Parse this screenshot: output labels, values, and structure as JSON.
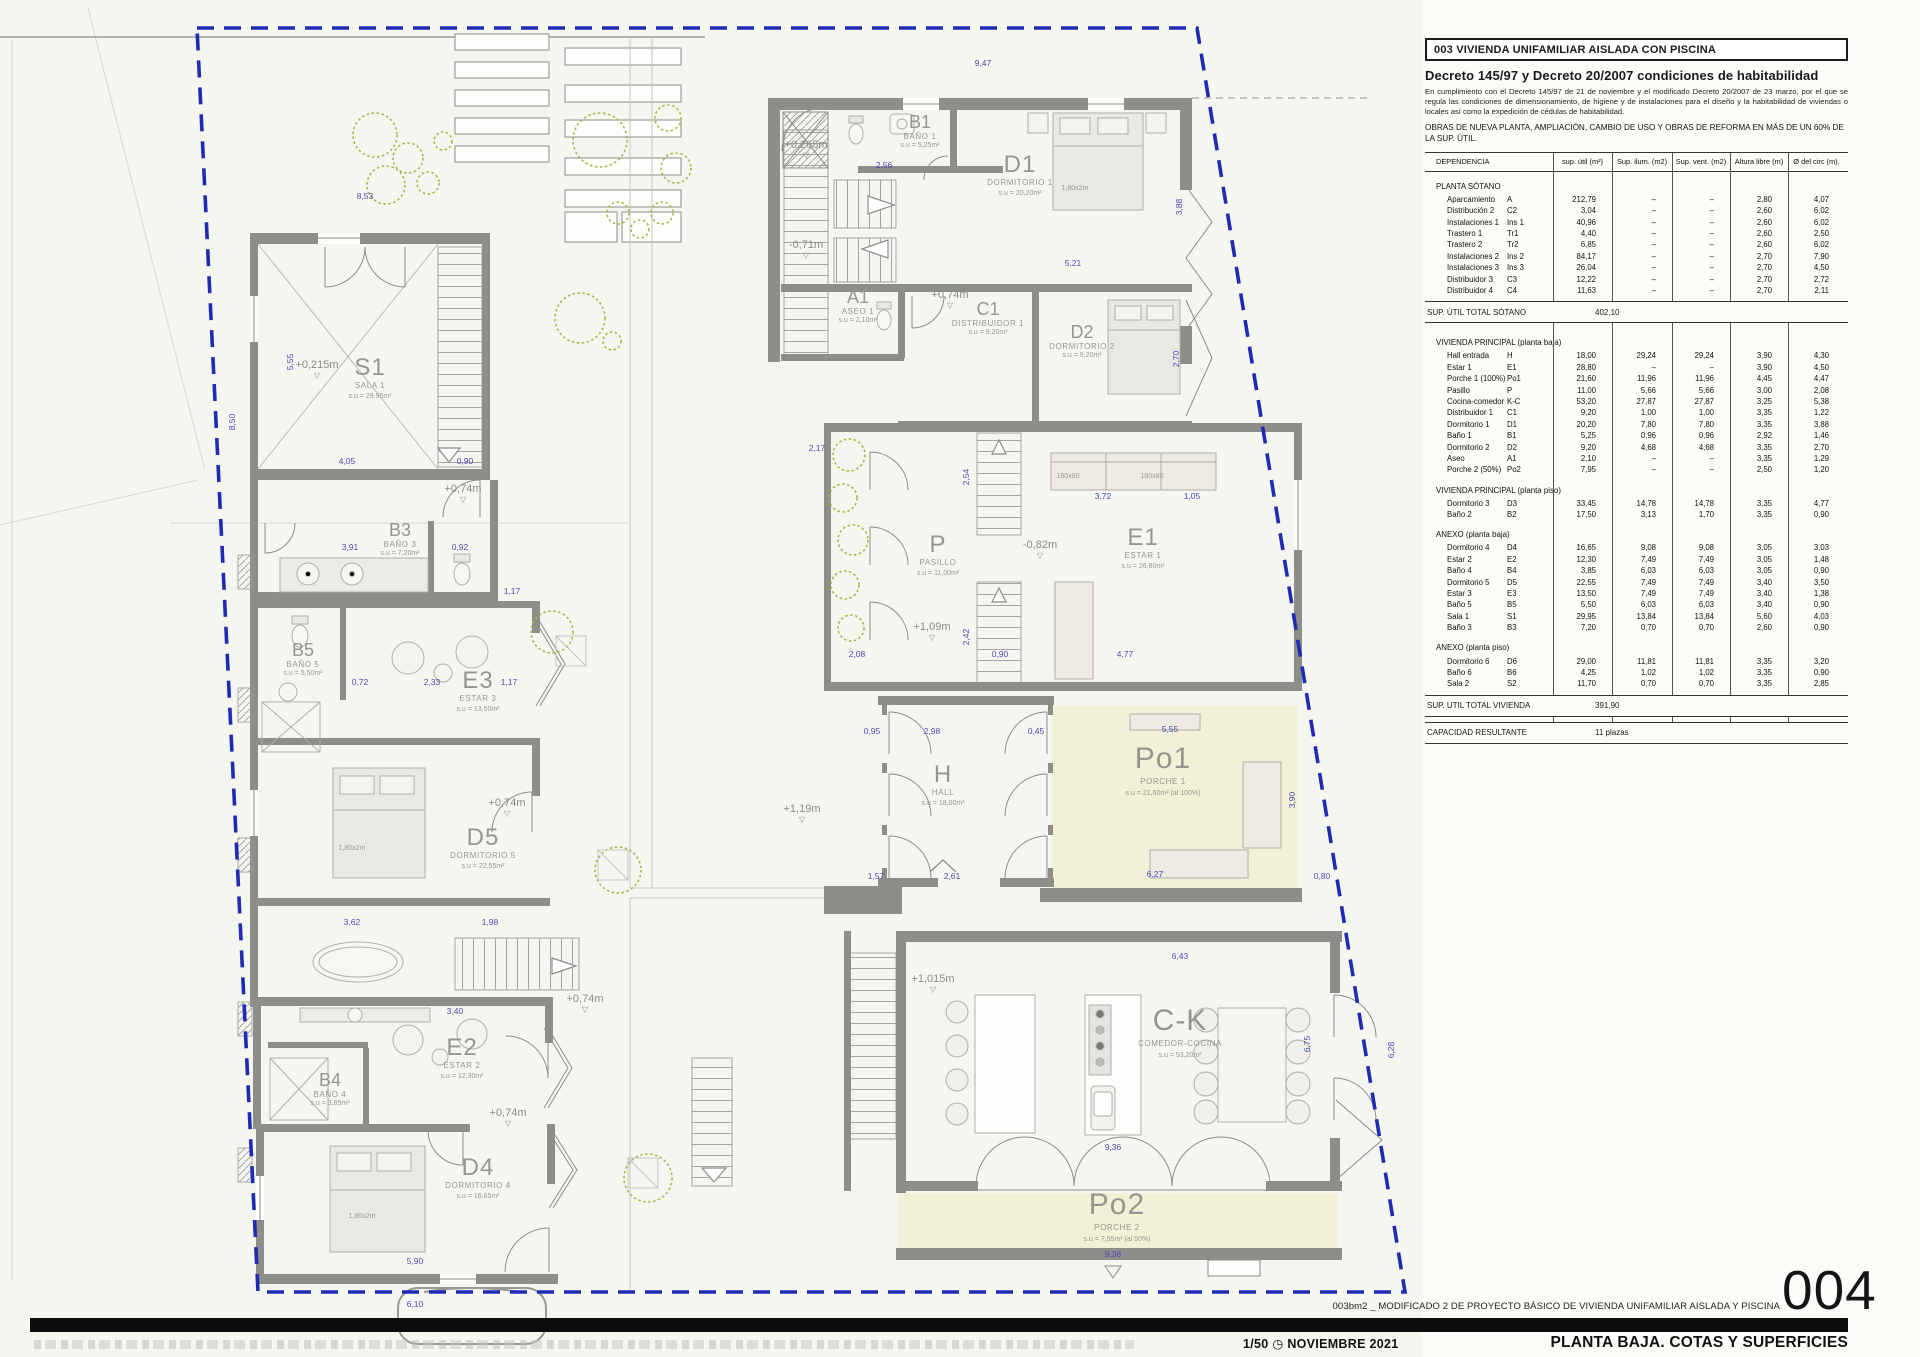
{
  "panel": {
    "title": "003 VIVIENDA UNIFAMILIAR AISLADA CON PISCINA",
    "decree_heading": "Decreto 145/97 y Decreto 20/2007 condiciones de habitabilidad",
    "decree_body": "En cumplimiento con el Decreto 145/97 de 21 de noviembre y el modificado Decreto 20/2007 de 23 marzo, por el que se regula las condiciones de dimensionamiento, de higiene y de instalaciones para el diseño y la habitabilidad de viviendas o locales así como la expedición de cédulas de habitabilidad.",
    "works_note": "OBRAS DE NUEVA PLANTA, AMPLIACIÓN, CAMBIO DE USO Y OBRAS DE REFORMA EN MÁS DE UN 60% DE LA SUP. ÚTIL.",
    "columns": [
      "DEPENDENCIA",
      "sup. útil (m²)",
      "Sup. ilum. (m2)",
      "Sup. vent. (m2)",
      "Altura libre (m)",
      "Ø del circ (m)."
    ],
    "rows": [
      {
        "t": "sec",
        "h": "PLANTA SÓTANO"
      },
      {
        "t": "r",
        "c": [
          "Aparcamiento",
          "A",
          "212,79",
          "–",
          "–",
          "2,80",
          "4,07"
        ]
      },
      {
        "t": "r",
        "c": [
          "Distribución 2",
          "C2",
          "3,04",
          "–",
          "–",
          "2,60",
          "6,02"
        ]
      },
      {
        "t": "r",
        "c": [
          "Instalaciones 1",
          "Ins 1",
          "40,96",
          "–",
          "–",
          "2,60",
          "6,02"
        ]
      },
      {
        "t": "r",
        "c": [
          "Trastero 1",
          "Tr1",
          "4,40",
          "–",
          "–",
          "2,60",
          "2,50"
        ]
      },
      {
        "t": "r",
        "c": [
          "Trastero 2",
          "Tr2",
          "6,85",
          "–",
          "–",
          "2,60",
          "6,02"
        ]
      },
      {
        "t": "r",
        "c": [
          "Instalaciones 2",
          "Ins 2",
          "84,17",
          "–",
          "–",
          "2,70",
          "7,90"
        ]
      },
      {
        "t": "r",
        "c": [
          "Instalaciones 3",
          "Ins 3",
          "26,04",
          "–",
          "–",
          "2,70",
          "4,50"
        ]
      },
      {
        "t": "r",
        "c": [
          "Distribuidor 3",
          "C3",
          "12,22",
          "–",
          "–",
          "2,70",
          "2,72"
        ]
      },
      {
        "t": "r",
        "c": [
          "Distribuidor 4",
          "C4",
          "11,63",
          "–",
          "–",
          "2,70",
          "2,11"
        ]
      },
      {
        "t": "tot",
        "l": "SUP. ÚTIL TOTAL SÓTANO",
        "v": "402,10"
      },
      {
        "t": "sec",
        "h": "VIVIENDA PRINCIPAL (planta baja)"
      },
      {
        "t": "r",
        "c": [
          "Hall entrada",
          "H",
          "18,00",
          "29,24",
          "29,24",
          "3,90",
          "4,30"
        ]
      },
      {
        "t": "r",
        "c": [
          "Estar 1",
          "E1",
          "28,80",
          "–",
          "–",
          "3,90",
          "4,50"
        ]
      },
      {
        "t": "r",
        "c": [
          "Porche 1 (100%)",
          "Po1",
          "21,60",
          "11,96",
          "11,96",
          "4,45",
          "4,47"
        ]
      },
      {
        "t": "r",
        "c": [
          "Pasillo",
          "P",
          "11,00",
          "5,66",
          "5,66",
          "3,00",
          "2,08"
        ]
      },
      {
        "t": "r",
        "c": [
          "Cocina-comedor",
          "K-C",
          "53,20",
          "27,87",
          "27,87",
          "3,25",
          "5,38"
        ]
      },
      {
        "t": "r",
        "c": [
          "Distribuidor 1",
          "C1",
          "9,20",
          "1,00",
          "1,00",
          "3,35",
          "1,22"
        ]
      },
      {
        "t": "r",
        "c": [
          "Dormitorio 1",
          "D1",
          "20,20",
          "7,80",
          "7,80",
          "3,35",
          "3,88"
        ]
      },
      {
        "t": "r",
        "c": [
          "Baño 1",
          "B1",
          "5,25",
          "0,96",
          "0,96",
          "2,92",
          "1,46"
        ]
      },
      {
        "t": "r",
        "c": [
          "Dormitorio 2",
          "D2",
          "9,20",
          "4,68",
          "4,68",
          "3,35",
          "2,70"
        ]
      },
      {
        "t": "r",
        "c": [
          "Aseo",
          "A1",
          "2,10",
          "–",
          "–",
          "3,35",
          "1,29"
        ]
      },
      {
        "t": "r",
        "c": [
          "Porche 2 (50%)",
          "Po2",
          "7,95",
          "–",
          "–",
          "2,50",
          "1,20"
        ]
      },
      {
        "t": "sec",
        "h": "VIVIENDA PRINCIPAL (planta piso)"
      },
      {
        "t": "r",
        "c": [
          "Dormitorio 3",
          "D3",
          "33,45",
          "14,78",
          "14,78",
          "3,35",
          "4,77"
        ]
      },
      {
        "t": "r",
        "c": [
          "Baño 2",
          "B2",
          "17,50",
          "3,13",
          "1,70",
          "3,35",
          "0,90"
        ]
      },
      {
        "t": "sec",
        "h": "ANEXO (planta baja)"
      },
      {
        "t": "r",
        "c": [
          "Dormitorio 4",
          "D4",
          "16,65",
          "9,08",
          "9,08",
          "3,05",
          "3,03"
        ]
      },
      {
        "t": "r",
        "c": [
          "Estar 2",
          "E2",
          "12,30",
          "7,49",
          "7,49",
          "3,05",
          "1,48"
        ]
      },
      {
        "t": "r",
        "c": [
          "Baño 4",
          "B4",
          "3,85",
          "6,03",
          "6,03",
          "3,05",
          "0,90"
        ]
      },
      {
        "t": "r",
        "c": [
          "Dormitorio 5",
          "D5",
          "22,55",
          "7,49",
          "7,49",
          "3,40",
          "3,50"
        ]
      },
      {
        "t": "r",
        "c": [
          "Estar 3",
          "E3",
          "13,50",
          "7,49",
          "7,49",
          "3,40",
          "1,38"
        ]
      },
      {
        "t": "r",
        "c": [
          "Baño 5",
          "B5",
          "5,50",
          "6,03",
          "6,03",
          "3,40",
          "0,90"
        ]
      },
      {
        "t": "r",
        "c": [
          "Sala 1",
          "S1",
          "29,95",
          "13,84",
          "13,84",
          "5,60",
          "4,03"
        ]
      },
      {
        "t": "r",
        "c": [
          "Baño 3",
          "B3",
          "7,20",
          "0,70",
          "0,70",
          "2,60",
          "0,90"
        ]
      },
      {
        "t": "sec",
        "h": "ANEXO (planta piso)"
      },
      {
        "t": "r",
        "c": [
          "Dormitorio 6",
          "D6",
          "29,00",
          "11,81",
          "11,81",
          "3,35",
          "3,20"
        ]
      },
      {
        "t": "r",
        "c": [
          "Baño 6",
          "B6",
          "4,25",
          "1,02",
          "1,02",
          "3,35",
          "0,90"
        ]
      },
      {
        "t": "r",
        "c": [
          "Sala 2",
          "S2",
          "11,70",
          "0,70",
          "0,70",
          "3,35",
          "2,85"
        ]
      },
      {
        "t": "tot",
        "l": "SUP. UTIL TOTAL VIVIENDA",
        "v": "391,90"
      },
      {
        "t": "tot",
        "l": "CAPACIDAD RESULTANTE",
        "v": "11 plazas"
      }
    ]
  },
  "plan": {
    "rooms": [
      {
        "code": "S1",
        "name": "SALA 1",
        "area": "s.u = 29,95m²",
        "x": 370,
        "y": 375,
        "size": "big"
      },
      {
        "code": "B3",
        "name": "BAÑO 3",
        "area": "s.u = 7,20m²",
        "x": 400,
        "y": 536,
        "size": "med"
      },
      {
        "code": "B5",
        "name": "BAÑO 5",
        "area": "s.u = 5,50m²",
        "x": 303,
        "y": 656,
        "size": "med"
      },
      {
        "code": "E3",
        "name": "ESTAR 3",
        "area": "s.u = 13,50m²",
        "x": 478,
        "y": 688,
        "size": "big"
      },
      {
        "code": "D5",
        "name": "DORMITORIO 5",
        "area": "s.u = 22,55m²",
        "x": 483,
        "y": 845,
        "size": "big"
      },
      {
        "code": "E2",
        "name": "ESTAR 2",
        "area": "s.u = 12,30m²",
        "x": 462,
        "y": 1055,
        "size": "big"
      },
      {
        "code": "B4",
        "name": "BAÑO 4",
        "area": "s.u = 3,85m²",
        "x": 330,
        "y": 1086,
        "size": "med"
      },
      {
        "code": "D4",
        "name": "DORMITORIO 4",
        "area": "s.u = 16,65m²",
        "x": 478,
        "y": 1175,
        "size": "big"
      },
      {
        "code": "B1",
        "name": "BAÑO 1",
        "area": "s.u = 5,25m²",
        "x": 920,
        "y": 128,
        "size": "med"
      },
      {
        "code": "D1",
        "name": "DORMITORIO 1",
        "area": "s.u = 20,20m²",
        "x": 1020,
        "y": 172,
        "size": "big"
      },
      {
        "code": "A1",
        "name": "ASEO 1",
        "area": "s.u = 2,10m²",
        "x": 858,
        "y": 303,
        "size": "med"
      },
      {
        "code": "C1",
        "name": "DISTRIBUIDOR 1",
        "area": "s.u = 9,20m²",
        "x": 988,
        "y": 315,
        "size": "med"
      },
      {
        "code": "D2",
        "name": "DORMITORIO 2",
        "area": "s.u = 9,20m²",
        "x": 1082,
        "y": 338,
        "size": "med"
      },
      {
        "code": "P",
        "name": "PASILLO",
        "area": "s.u = 11,00m²",
        "x": 938,
        "y": 552,
        "size": "big"
      },
      {
        "code": "E1",
        "name": "ESTAR 1",
        "area": "s.u = 26,80m²",
        "x": 1143,
        "y": 545,
        "size": "big"
      },
      {
        "code": "H",
        "name": "HALL",
        "area": "s.u = 18,00m²",
        "x": 943,
        "y": 782,
        "size": "big"
      },
      {
        "code": "Po1",
        "name": "PORCHE 1",
        "area": "s.u = 21,60m² (al 100%)",
        "x": 1163,
        "y": 768,
        "size": "xl"
      },
      {
        "code": "C-K",
        "name": "COMEDOR-COCINA",
        "area": "s.u = 53,20m²",
        "x": 1180,
        "y": 1030,
        "size": "xl"
      },
      {
        "code": "Po2",
        "name": "PORCHE 2",
        "area": "s.u = 7,95m² (al 50%)",
        "x": 1117,
        "y": 1214,
        "size": "xl"
      }
    ],
    "levels": [
      {
        "v": "+0,215m",
        "x": 317,
        "y": 368
      },
      {
        "v": "+0,74m",
        "x": 463,
        "y": 492
      },
      {
        "v": "+0,265m",
        "x": 806,
        "y": 148
      },
      {
        "v": "-0,71m",
        "x": 806,
        "y": 248
      },
      {
        "v": "+0,74m",
        "x": 950,
        "y": 298
      },
      {
        "v": "-0,82m",
        "x": 1040,
        "y": 548
      },
      {
        "v": "+1,09m",
        "x": 932,
        "y": 630
      },
      {
        "v": "+0,74m",
        "x": 507,
        "y": 806
      },
      {
        "v": "+1,19m",
        "x": 802,
        "y": 812
      },
      {
        "v": "+0,74m",
        "x": 508,
        "y": 1116
      },
      {
        "v": "+1,015m",
        "x": 933,
        "y": 982
      },
      {
        "v": "+0,74m",
        "x": 585,
        "y": 1002
      }
    ],
    "dims": [
      {
        "v": "8,53",
        "x": 365,
        "y": 199
      },
      {
        "v": "9,47",
        "x": 983,
        "y": 66
      },
      {
        "v": "5,21",
        "x": 1073,
        "y": 266
      },
      {
        "v": "2,56",
        "x": 884,
        "y": 168
      },
      {
        "v": "3,72",
        "x": 1103,
        "y": 499
      },
      {
        "v": "1,05",
        "x": 1192,
        "y": 499
      },
      {
        "v": "2,17",
        "x": 817,
        "y": 451
      },
      {
        "v": "2,08",
        "x": 857,
        "y": 657
      },
      {
        "v": "0,90",
        "x": 1000,
        "y": 657
      },
      {
        "v": "4,77",
        "x": 1125,
        "y": 657
      },
      {
        "v": "2,98",
        "x": 932,
        "y": 734
      },
      {
        "v": "0,95",
        "x": 872,
        "y": 734
      },
      {
        "v": "0,45",
        "x": 1036,
        "y": 734
      },
      {
        "v": "1,57",
        "x": 876,
        "y": 879
      },
      {
        "v": "2,61",
        "x": 952,
        "y": 879
      },
      {
        "v": "5,55",
        "x": 1170,
        "y": 732
      },
      {
        "v": "6,27",
        "x": 1155,
        "y": 877
      },
      {
        "v": "0,80",
        "x": 1322,
        "y": 879
      },
      {
        "v": "6,43",
        "x": 1180,
        "y": 959
      },
      {
        "v": "9,36",
        "x": 1113,
        "y": 1150
      },
      {
        "v": "9,36",
        "x": 1113,
        "y": 1257
      },
      {
        "v": "6,10",
        "x": 415,
        "y": 1307
      },
      {
        "v": "4,05",
        "x": 347,
        "y": 464
      },
      {
        "v": "0,90",
        "x": 465,
        "y": 464
      },
      {
        "v": "3,91",
        "x": 350,
        "y": 550
      },
      {
        "v": "0,92",
        "x": 460,
        "y": 550
      },
      {
        "v": "1,17",
        "x": 512,
        "y": 594
      },
      {
        "v": "0,72",
        "x": 360,
        "y": 685
      },
      {
        "v": "2,33",
        "x": 432,
        "y": 685
      },
      {
        "v": "1,17",
        "x": 509,
        "y": 685
      },
      {
        "v": "3,62",
        "x": 352,
        "y": 925
      },
      {
        "v": "1,98",
        "x": 490,
        "y": 925
      },
      {
        "v": "3,40",
        "x": 455,
        "y": 1014
      },
      {
        "v": "5,90",
        "x": 415,
        "y": 1264
      },
      {
        "v": "6,75",
        "x": 1310,
        "y": 1044,
        "rot": 1
      },
      {
        "v": "6,28",
        "x": 1394,
        "y": 1050,
        "rot": 1
      },
      {
        "v": "3,90",
        "x": 1295,
        "y": 800,
        "rot": 1
      },
      {
        "v": "2,54",
        "x": 969,
        "y": 477,
        "rot": 1
      },
      {
        "v": "2,42",
        "x": 969,
        "y": 637,
        "rot": 1
      },
      {
        "v": "3,88",
        "x": 1182,
        "y": 207,
        "rot": 1
      },
      {
        "v": "2,70",
        "x": 1179,
        "y": 359,
        "rot": 1
      },
      {
        "v": "8,50",
        "x": 235,
        "y": 422,
        "rot": 1
      },
      {
        "v": "5,55",
        "x": 293,
        "y": 362,
        "rot": 1
      },
      {
        "v": "1,80x2m",
        "x": 352,
        "y": 850,
        "g": 1
      },
      {
        "v": "1,80x2m",
        "x": 362,
        "y": 1218,
        "g": 1
      },
      {
        "v": "1,80x2m",
        "x": 1075,
        "y": 190,
        "g": 1
      },
      {
        "v": "180x80",
        "x": 1068,
        "y": 478,
        "g": 1
      },
      {
        "v": "180x80",
        "x": 1152,
        "y": 478,
        "g": 1
      }
    ]
  },
  "titleblock": {
    "project": "003bm2 _ MODIFICADO 2 DE PROYECTO BÁSICO DE VIVIENDA UNIFAMILIAR AISLADA Y PISCINA",
    "sheet_number": "004",
    "scale": "1/50",
    "date": "NOVIEMBRE 2021",
    "sheet_title": "PLANTA BAJA. COTAS Y SUPERFICIES",
    "clock_icon": "◷"
  }
}
